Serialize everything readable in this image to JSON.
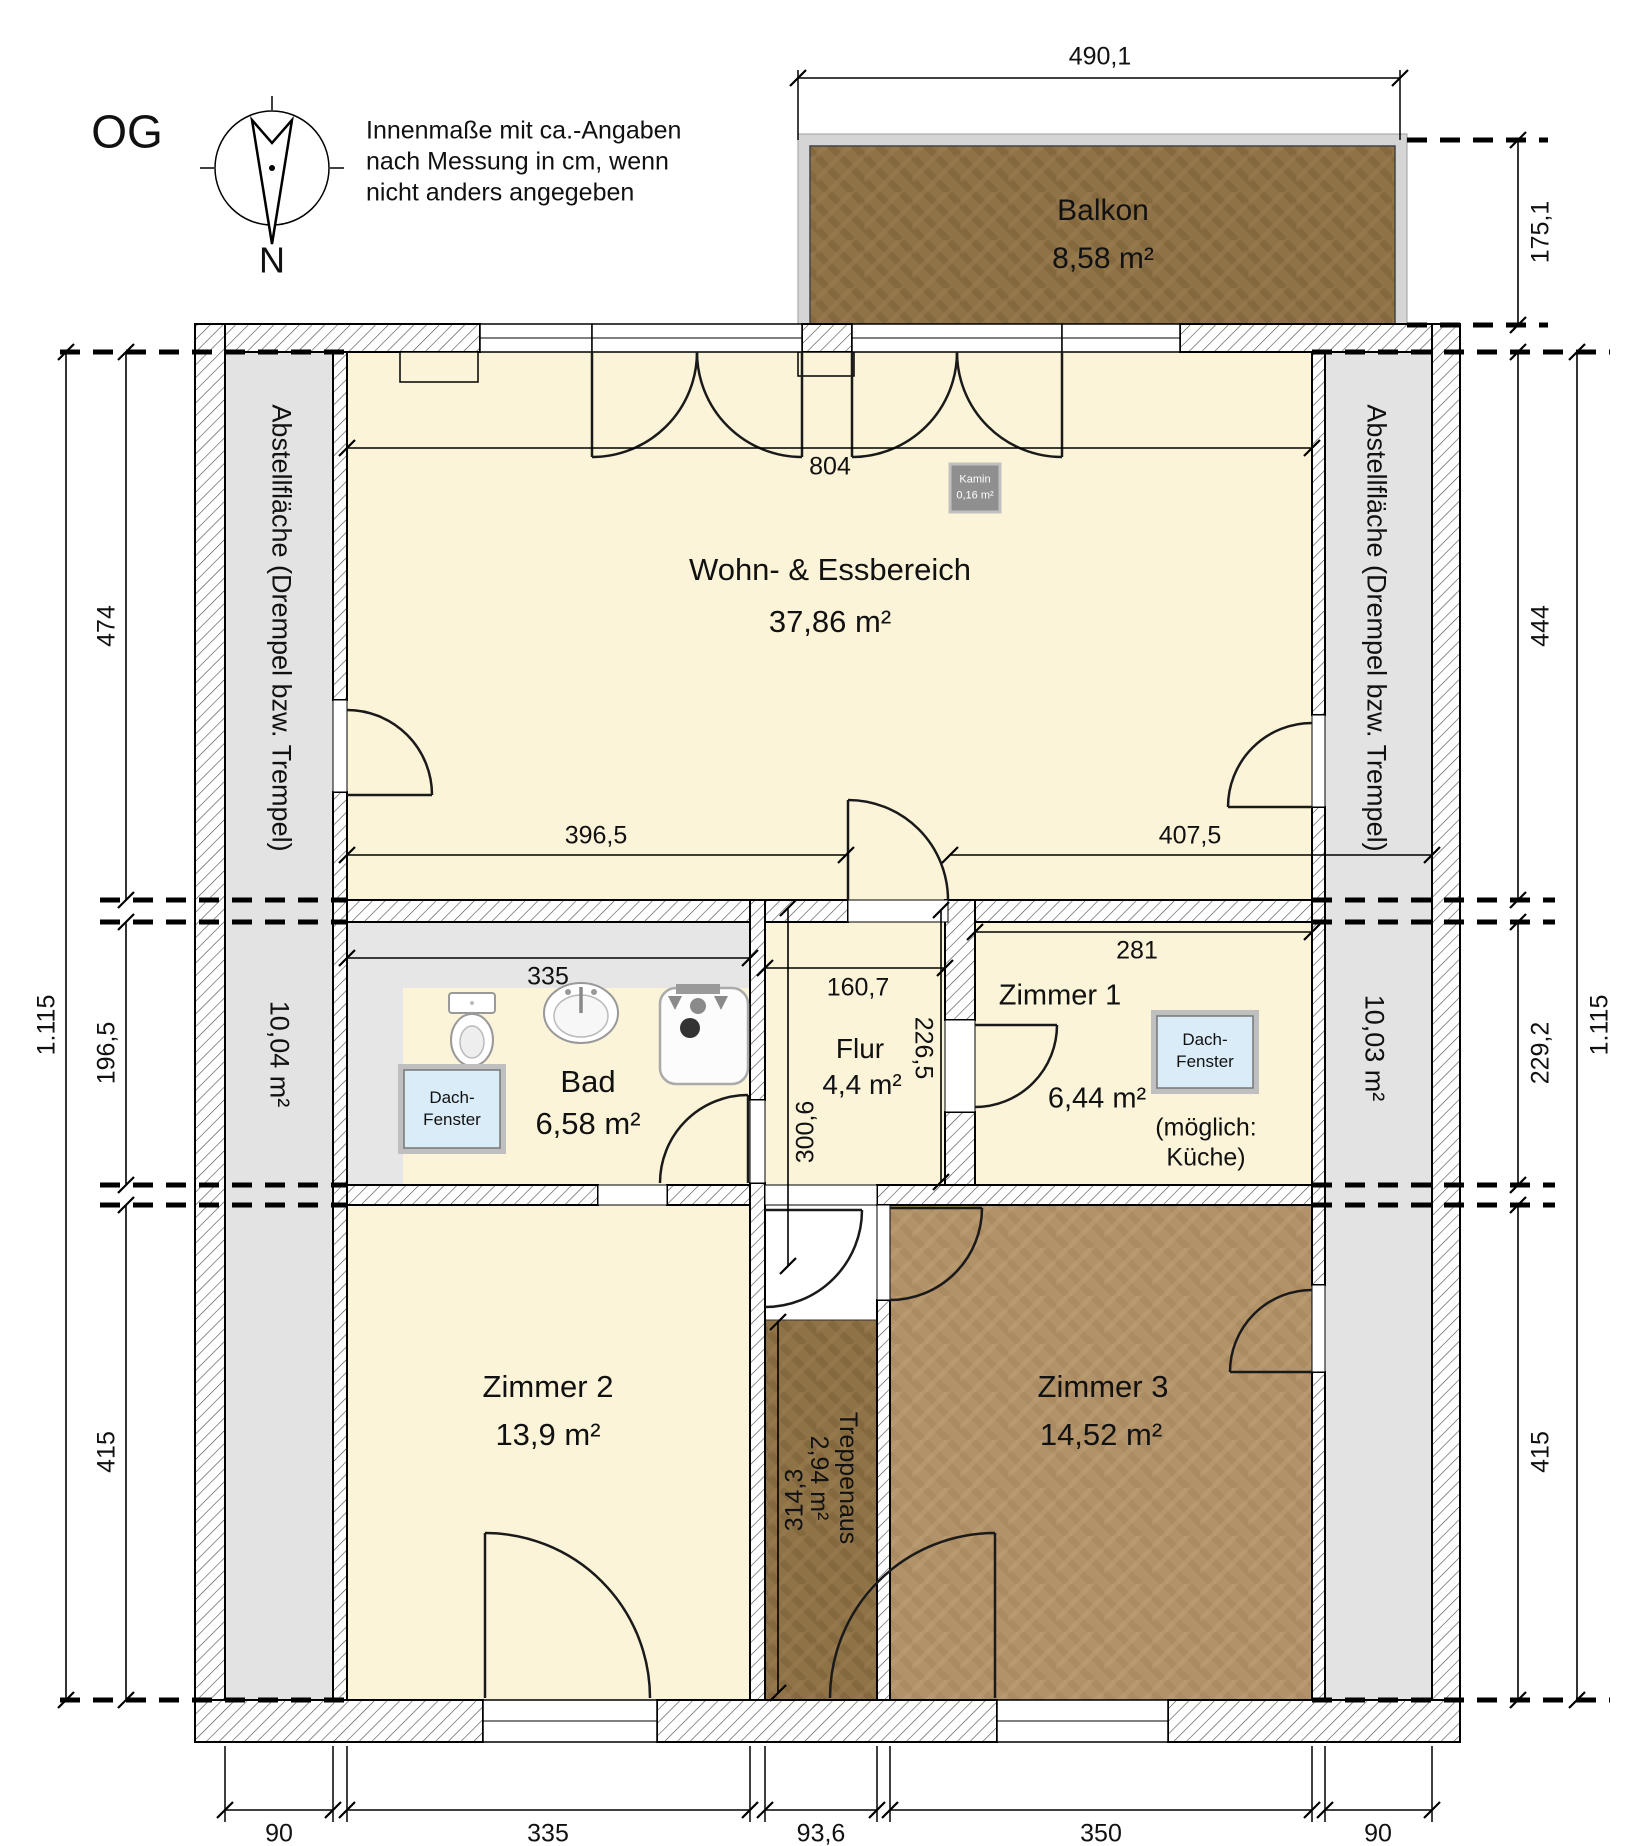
{
  "title": "OG",
  "note": {
    "line1": "Innenmaße mit ca.-Angaben",
    "line2": "nach Messung in cm, wenn",
    "line3": "nicht anders angegeben"
  },
  "compass": {
    "north_label": "N"
  },
  "rooms": {
    "balkon": {
      "name": "Balkon",
      "area": "8,58 m²"
    },
    "wohn_essbereich": {
      "name": "Wohn- & Essbereich",
      "area": "37,86 m²"
    },
    "kamin": {
      "name": "Kamin",
      "area": "0,16 m²"
    },
    "bad": {
      "name": "Bad",
      "area": "6,58 m²"
    },
    "flur": {
      "name": "Flur",
      "area": "4,4 m²"
    },
    "zimmer1": {
      "name": "Zimmer 1",
      "area": "6,44 m²",
      "note_line1": "(möglich:",
      "note_line2": "Küche)"
    },
    "zimmer2": {
      "name": "Zimmer 2",
      "area": "13,9 m²"
    },
    "zimmer3": {
      "name": "Zimmer 3",
      "area": "14,52 m²"
    },
    "treppenhaus": {
      "name": "Treppenaus",
      "area": "2,94 m²"
    },
    "abstell_left": {
      "name": "Abstellfläche (Drempel bzw. Trempel)",
      "area": "10,04 m²"
    },
    "abstell_right": {
      "name": "Abstellfläche (Drempel bzw. Trempel)",
      "area": "10,03 m²"
    }
  },
  "windows": {
    "dachfenster_line1": "Dach-",
    "dachfenster_line2": "Fenster"
  },
  "dimensions": {
    "balkon_width": "490,1",
    "balkon_depth": "175,1",
    "wohn_width": "804",
    "wohn_left": "396,5",
    "wohn_right": "407,5",
    "bad_width": "335",
    "flur_width": "160,7",
    "flur_height_left": "300,6",
    "flur_height_right": "226,5",
    "zimmer1_width": "281",
    "treppe_height": "314,3",
    "left_474": "474",
    "left_196_5": "196,5",
    "left_415": "415",
    "left_total": "1.115",
    "right_444": "444",
    "right_229_2": "229,2",
    "right_415": "415",
    "right_total": "1.115",
    "bottom_90_left": "90",
    "bottom_335": "335",
    "bottom_93_6": "93,6",
    "bottom_350": "350",
    "bottom_90_right": "90"
  },
  "colors": {
    "room_fill": "#FBF4D8",
    "storage_gray": "#E3E3E3",
    "wood_dark": "#8F7347",
    "wood_light": "#B29268",
    "balcony_rim": "#D5D5D5",
    "dachfenster_blue": "#D9ECF7",
    "kamin_gray": "#8F8F8F"
  }
}
